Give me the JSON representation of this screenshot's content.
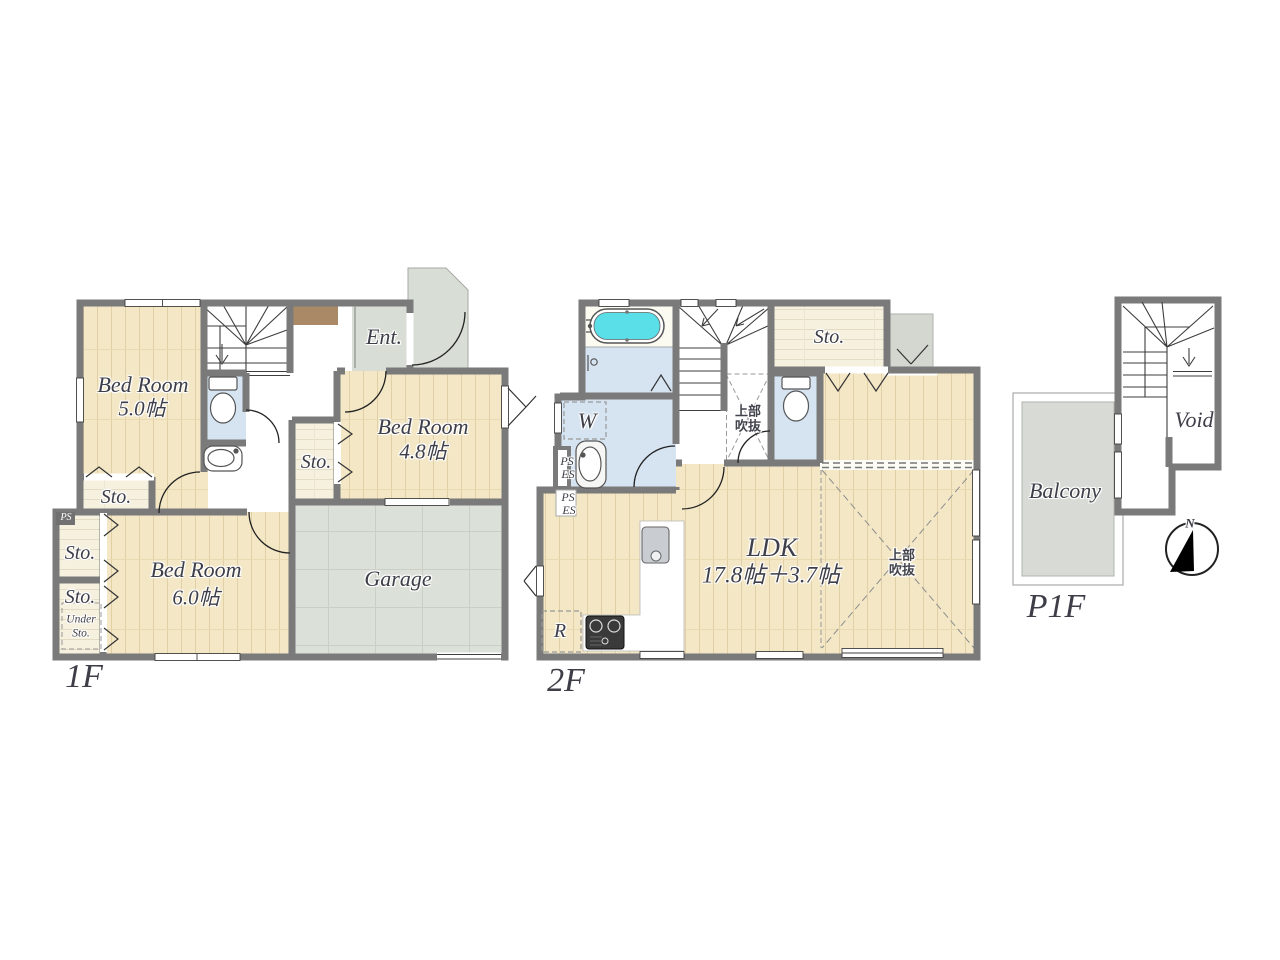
{
  "palette": {
    "wall": "#7a7a7a",
    "wood_floor": "#f3e7c6",
    "storage_floor": "#f6f0df",
    "concrete_floor": "#dbe0d8",
    "wet_area": "#d6e4f2",
    "bathtub": "#5adee8",
    "entrance_mat": "#aa8a66",
    "label_text": "#3e3e48"
  },
  "floor_1f": {
    "label": "1F",
    "bed5": {
      "name": "Bed Room",
      "size": "5.0帖"
    },
    "bed6": {
      "name": "Bed Room",
      "size": "6.0帖"
    },
    "bed48": {
      "name": "Bed Room",
      "size": "4.8帖"
    },
    "garage": "Garage",
    "entrance": "Ent.",
    "sto": "Sto.",
    "ps": "PS",
    "under_sto_line1": "Under",
    "under_sto_line2": "Sto."
  },
  "floor_2f": {
    "label": "2F",
    "sto": "Sto.",
    "washroom": "W",
    "refrigerator": "R",
    "ps": "PS",
    "es": "ES",
    "ldk": {
      "name": "LDK",
      "size": "17.8帖＋3.7帖"
    },
    "void_above_line1": "上部",
    "void_above_line2": "吹抜"
  },
  "floor_p1f": {
    "label": "P1F",
    "balcony": "Balcony",
    "void": "Void"
  },
  "compass_north": "N"
}
